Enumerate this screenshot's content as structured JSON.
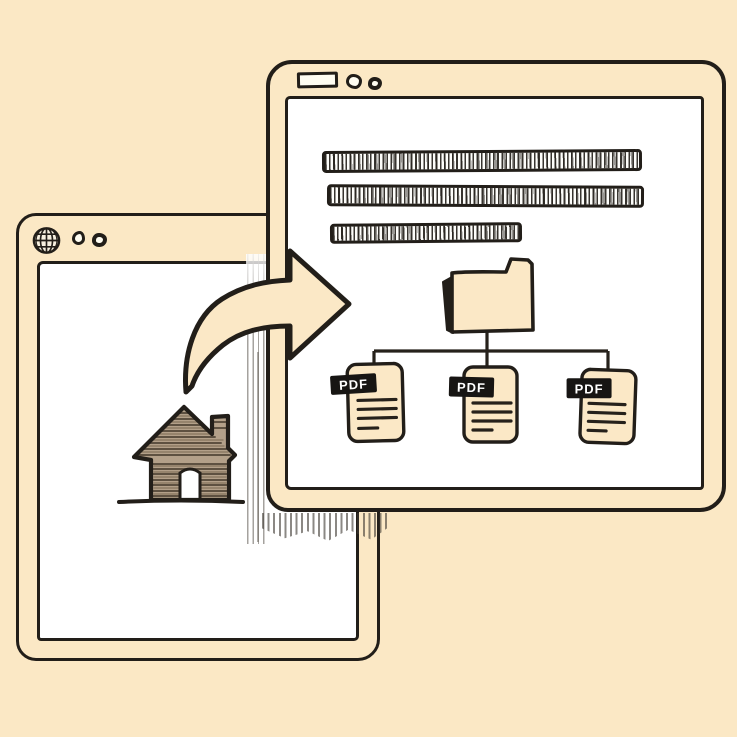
{
  "colors": {
    "background": "#fbe8c5",
    "outline": "#221e19",
    "window_fill": "#fbe8c5",
    "content_white": "#ffffff",
    "paper_cream": "#fbe8c6",
    "house_fill": "#b3a089",
    "badge_fill": "#171513",
    "badge_text_color": "#ffffff",
    "shadow_gray": "#6f6a62"
  },
  "back_window": {
    "name": "home-browser-window",
    "titlebar": {
      "icons": [
        "globe-icon",
        "dot",
        "dot"
      ]
    },
    "content": {
      "icons": [
        "house-icon"
      ]
    }
  },
  "front_window": {
    "name": "pdf-browser-window",
    "titlebar": {
      "icons": [
        "address-box",
        "dot",
        "dot"
      ]
    },
    "content": {
      "text_line_count": 3,
      "icons": [
        "folder-icon"
      ],
      "documents": [
        {
          "label": "PDF"
        },
        {
          "label": "PDF"
        },
        {
          "label": "PDF"
        }
      ]
    }
  },
  "arrow": {
    "name": "curved-right-arrow",
    "direction": "right"
  }
}
